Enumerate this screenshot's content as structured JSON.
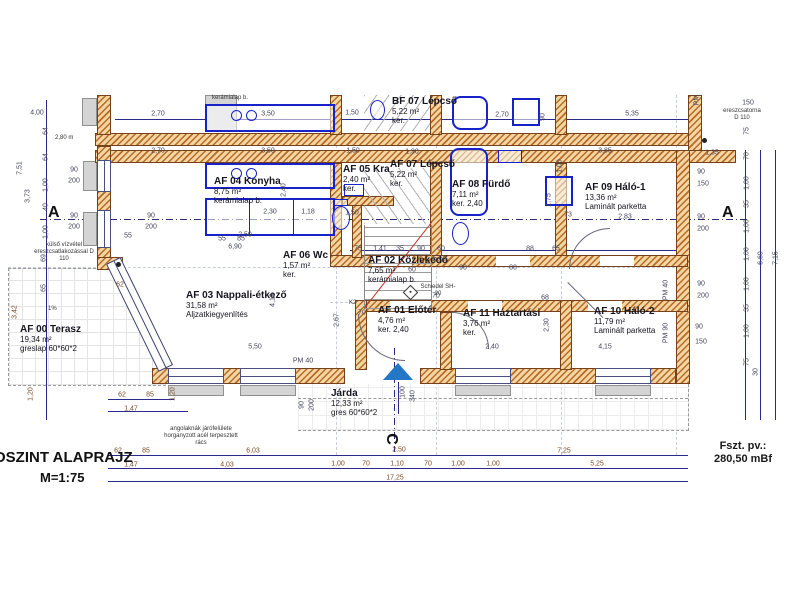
{
  "sheet": {
    "title": "OSZINT ALAPRAJZ",
    "scale": "M=1:75",
    "level_label": "Fszt. pv.:",
    "level_value": "280,50 mBf",
    "section_marker_a": "A",
    "section_marker_c": "C"
  },
  "colors": {
    "wall_hatch": "#b96a24",
    "wall_fill": "#f2d5a2",
    "dim_line": "#2a2a8a",
    "fixture_blue": "#1722c8",
    "stair_slope_red": "#c03022",
    "entry_arrow_blue": "#2477c6"
  },
  "rooms": [
    {
      "id": "af00",
      "name": "AF 00 Terasz",
      "area": "19,34 m²",
      "finish": "greslap 60*60*2",
      "x": 20,
      "y": 324
    },
    {
      "id": "af03",
      "name": "AF 03 Nappali-étkező",
      "area": "31,58 m²",
      "finish": "Aljzatkiegyenlítés",
      "x": 186,
      "y": 290
    },
    {
      "id": "af04",
      "name": "AF 04 Konyha",
      "area": "8,75 m²",
      "finish": "kerámialap b.",
      "x": 214,
      "y": 176
    },
    {
      "id": "af05",
      "name": "AF 05 Kra",
      "area": "2,40 m²",
      "finish": "ker.",
      "x": 343,
      "y": 164
    },
    {
      "id": "af06",
      "name": "AF 06 Wc",
      "area": "1,57 m²",
      "finish": "ker.",
      "x": 283,
      "y": 250
    },
    {
      "id": "af07",
      "name": "AF 07 Lépcső",
      "area": "5,22 m²",
      "finish": "ker.",
      "x": 390,
      "y": 159
    },
    {
      "id": "af08",
      "name": "AF 08 Fürdő",
      "area": "7,11 m²",
      "finish": "ker. 2,40",
      "x": 452,
      "y": 179
    },
    {
      "id": "af09",
      "name": "AF 09 Háló-1",
      "area": "13,36 m²",
      "finish": "Laminált parketta",
      "x": 585,
      "y": 182
    },
    {
      "id": "af02",
      "name": "AF 02 Közlekedő",
      "area": "7,65 m²",
      "finish": "kerámialap b.",
      "x": 368,
      "y": 255
    },
    {
      "id": "af01",
      "name": "AF 01 Előtér",
      "area": "4,76 m²",
      "finish": "ker. 2,40",
      "x": 378,
      "y": 305
    },
    {
      "id": "af11",
      "name": "AF 11 Háztartási",
      "area": "3,76 m²",
      "finish": "ker.",
      "x": 463,
      "y": 308
    },
    {
      "id": "af10",
      "name": "AF 10 Háló-2",
      "area": "11,79 m²",
      "finish": "Laminált parketta",
      "x": 594,
      "y": 306
    },
    {
      "id": "jarda",
      "name": "Járda",
      "area": "12,33 m²",
      "finish": "gres 60*60*2",
      "x": 331,
      "y": 388
    },
    {
      "id": "bf07",
      "name": "BF 07 Lépcső",
      "area": "5,22 m²",
      "finish": "ker.",
      "x": 392,
      "y": 96
    }
  ],
  "notes": [
    {
      "text": "Schiedel SH-20",
      "x": 420,
      "y": 284,
      "w": 36,
      "ctr": 1
    },
    {
      "text": "ereszcsatorna D 110",
      "x": 722,
      "y": 108,
      "w": 40,
      "ctr": 1
    },
    {
      "text": "külső vízvétel ereszcsatlakozással D 110",
      "x": 34,
      "y": 242,
      "w": 60,
      "ctr": 1
    },
    {
      "text": "angolaknák járófelülete horganyzott acél terpesztett rács",
      "x": 164,
      "y": 426,
      "w": 74,
      "ctr": 1
    },
    {
      "text": "1%",
      "x": 48,
      "y": 306,
      "w": 16,
      "ctr": 0
    },
    {
      "text": "kerámialap b.",
      "x": 212,
      "y": 95,
      "w": 50,
      "ctr": 0
    },
    {
      "text": "2,80 m",
      "x": 55,
      "y": 135,
      "w": 30,
      "ctr": 0
    },
    {
      "text": "K2",
      "x": 349,
      "y": 300,
      "w": 14,
      "ctr": 0
    }
  ],
  "dims": [
    {
      "t": "2,70",
      "x": 158,
      "y": 114
    },
    {
      "t": "3,50",
      "x": 268,
      "y": 114
    },
    {
      "t": "1,50",
      "x": 352,
      "y": 113
    },
    {
      "t": "2,70",
      "x": 502,
      "y": 115
    },
    {
      "t": "5,35",
      "x": 632,
      "y": 114
    },
    {
      "t": "2,70",
      "x": 158,
      "y": 151
    },
    {
      "t": "3,50",
      "x": 268,
      "y": 151
    },
    {
      "t": "1,50",
      "x": 353,
      "y": 151
    },
    {
      "t": "1,90",
      "x": 412,
      "y": 152
    },
    {
      "t": "3,85",
      "x": 605,
      "y": 151
    },
    {
      "t": "1,35",
      "x": 712,
      "y": 153
    },
    {
      "t": "90",
      "x": 543,
      "y": 117,
      "r": 1
    },
    {
      "t": "1,00",
      "x": 560,
      "y": 166,
      "r": 1
    },
    {
      "t": "4,00",
      "x": 37,
      "y": 113
    },
    {
      "t": "64",
      "x": 46,
      "y": 131,
      "r": 1
    },
    {
      "t": "64",
      "x": 46,
      "y": 157,
      "r": 1
    },
    {
      "t": "1,00",
      "x": 46,
      "y": 185,
      "r": 1
    },
    {
      "t": "40",
      "x": 46,
      "y": 207,
      "r": 1
    },
    {
      "t": "1,00",
      "x": 46,
      "y": 232,
      "r": 1
    },
    {
      "t": "69",
      "x": 44,
      "y": 258,
      "r": 1
    },
    {
      "t": "65",
      "x": 44,
      "y": 288,
      "r": 1
    },
    {
      "t": "3,73",
      "x": 28,
      "y": 196,
      "r": 1
    },
    {
      "t": "7,51",
      "x": 20,
      "y": 168,
      "r": 1
    },
    {
      "t": "90",
      "x": 74,
      "y": 170
    },
    {
      "t": "200",
      "x": 74,
      "y": 181
    },
    {
      "t": "90",
      "x": 74,
      "y": 216
    },
    {
      "t": "200",
      "x": 74,
      "y": 227
    },
    {
      "t": "90",
      "x": 151,
      "y": 216
    },
    {
      "t": "200",
      "x": 151,
      "y": 227
    },
    {
      "t": "55",
      "x": 128,
      "y": 236
    },
    {
      "t": "55",
      "x": 222,
      "y": 239
    },
    {
      "t": "85",
      "x": 241,
      "y": 239
    },
    {
      "t": "150",
      "x": 748,
      "y": 103
    },
    {
      "t": "PM",
      "x": 697,
      "y": 100,
      "r": 1
    },
    {
      "t": "75",
      "x": 747,
      "y": 131,
      "r": 1
    },
    {
      "t": "70",
      "x": 747,
      "y": 156,
      "r": 1
    },
    {
      "t": "1,00",
      "x": 747,
      "y": 183,
      "r": 1
    },
    {
      "t": "35",
      "x": 747,
      "y": 204,
      "r": 1
    },
    {
      "t": "1,00",
      "x": 747,
      "y": 226,
      "r": 1
    },
    {
      "t": "1,00",
      "x": 747,
      "y": 254,
      "r": 1
    },
    {
      "t": "1,00",
      "x": 747,
      "y": 284,
      "r": 1
    },
    {
      "t": "35",
      "x": 747,
      "y": 308,
      "r": 1
    },
    {
      "t": "1,00",
      "x": 747,
      "y": 331,
      "r": 1
    },
    {
      "t": "75",
      "x": 747,
      "y": 362,
      "r": 1
    },
    {
      "t": "30",
      "x": 756,
      "y": 372,
      "r": 1
    },
    {
      "t": "6,60",
      "x": 761,
      "y": 258,
      "r": 1
    },
    {
      "t": "7,15",
      "x": 776,
      "y": 258,
      "r": 1
    },
    {
      "t": "90",
      "x": 701,
      "y": 172
    },
    {
      "t": "150",
      "x": 703,
      "y": 184
    },
    {
      "t": "90",
      "x": 701,
      "y": 217
    },
    {
      "t": "200",
      "x": 703,
      "y": 229
    },
    {
      "t": "90",
      "x": 701,
      "y": 284
    },
    {
      "t": "200",
      "x": 703,
      "y": 296
    },
    {
      "t": "90",
      "x": 699,
      "y": 327
    },
    {
      "t": "150",
      "x": 701,
      "y": 342
    },
    {
      "t": "PM 40",
      "x": 666,
      "y": 290,
      "r": 1
    },
    {
      "t": "PM 90",
      "x": 666,
      "y": 333,
      "r": 1
    },
    {
      "t": "62",
      "x": 118,
      "y": 451,
      "c": 1
    },
    {
      "t": "85",
      "x": 146,
      "y": 451,
      "c": 1
    },
    {
      "t": "6,03",
      "x": 253,
      "y": 451,
      "c": 1
    },
    {
      "t": "2,50",
      "x": 399,
      "y": 450,
      "c": 1
    },
    {
      "t": "7,25",
      "x": 564,
      "y": 451,
      "c": 1
    },
    {
      "t": "1,47",
      "x": 131,
      "y": 465,
      "c": 1
    },
    {
      "t": "4,03",
      "x": 227,
      "y": 465,
      "c": 1
    },
    {
      "t": "1,00",
      "x": 338,
      "y": 464,
      "c": 1
    },
    {
      "t": "70",
      "x": 366,
      "y": 464,
      "c": 1
    },
    {
      "t": "1,10",
      "x": 397,
      "y": 464,
      "c": 1
    },
    {
      "t": "70",
      "x": 428,
      "y": 464,
      "c": 1
    },
    {
      "t": "1,00",
      "x": 458,
      "y": 464,
      "c": 1
    },
    {
      "t": "1,00",
      "x": 493,
      "y": 464,
      "c": 1
    },
    {
      "t": "5,25",
      "x": 597,
      "y": 464,
      "c": 1
    },
    {
      "t": "17,25",
      "x": 395,
      "y": 478,
      "c": 1
    },
    {
      "t": "62",
      "x": 120,
      "y": 285,
      "c": 1
    },
    {
      "t": "3,42",
      "x": 15,
      "y": 312,
      "r": 1,
      "c": 1
    },
    {
      "t": "1,20",
      "x": 31,
      "y": 394,
      "r": 1,
      "c": 1
    },
    {
      "t": "62",
      "x": 122,
      "y": 395,
      "c": 1
    },
    {
      "t": "85",
      "x": 150,
      "y": 395,
      "c": 1
    },
    {
      "t": "1,47",
      "x": 131,
      "y": 409,
      "c": 1
    },
    {
      "t": "1,20",
      "x": 173,
      "y": 394,
      "r": 1,
      "c": 1
    },
    {
      "t": "2,30",
      "x": 270,
      "y": 212
    },
    {
      "t": "2,40",
      "x": 284,
      "y": 190,
      "r": 1
    },
    {
      "t": "1,18",
      "x": 308,
      "y": 212
    },
    {
      "t": "1,50",
      "x": 352,
      "y": 213
    },
    {
      "t": "2,50",
      "x": 245,
      "y": 235
    },
    {
      "t": "6,90",
      "x": 235,
      "y": 247
    },
    {
      "t": "5,50",
      "x": 255,
      "y": 347
    },
    {
      "t": "4,10",
      "x": 273,
      "y": 300,
      "r": 1
    },
    {
      "t": "2,67",
      "x": 337,
      "y": 320,
      "r": 1
    },
    {
      "t": "PM 40",
      "x": 303,
      "y": 361
    },
    {
      "t": "75",
      "x": 358,
      "y": 249
    },
    {
      "t": "1,41",
      "x": 380,
      "y": 249
    },
    {
      "t": "35",
      "x": 400,
      "y": 249
    },
    {
      "t": "90",
      "x": 421,
      "y": 249
    },
    {
      "t": "60",
      "x": 441,
      "y": 249
    },
    {
      "t": "88",
      "x": 530,
      "y": 249
    },
    {
      "t": "65",
      "x": 556,
      "y": 249
    },
    {
      "t": "5,50",
      "x": 440,
      "y": 259
    },
    {
      "t": "60",
      "x": 412,
      "y": 270
    },
    {
      "t": "90",
      "x": 463,
      "y": 268
    },
    {
      "t": "80",
      "x": 513,
      "y": 268
    },
    {
      "t": "70",
      "x": 436,
      "y": 296
    },
    {
      "t": "70",
      "x": 362,
      "y": 313
    },
    {
      "t": "2,40",
      "x": 492,
      "y": 347
    },
    {
      "t": "2,30",
      "x": 547,
      "y": 325,
      "r": 1
    },
    {
      "t": "68",
      "x": 545,
      "y": 298
    },
    {
      "t": "4,15",
      "x": 605,
      "y": 347
    },
    {
      "t": "2,83",
      "x": 625,
      "y": 217
    },
    {
      "t": "73",
      "x": 568,
      "y": 215
    },
    {
      "t": "1,75",
      "x": 549,
      "y": 200,
      "r": 1
    },
    {
      "t": "90",
      "x": 302,
      "y": 405,
      "r": 1
    },
    {
      "t": "200",
      "x": 312,
      "y": 405,
      "r": 1
    },
    {
      "t": "100",
      "x": 403,
      "y": 392,
      "r": 1
    },
    {
      "t": "340",
      "x": 413,
      "y": 396,
      "r": 1
    }
  ]
}
